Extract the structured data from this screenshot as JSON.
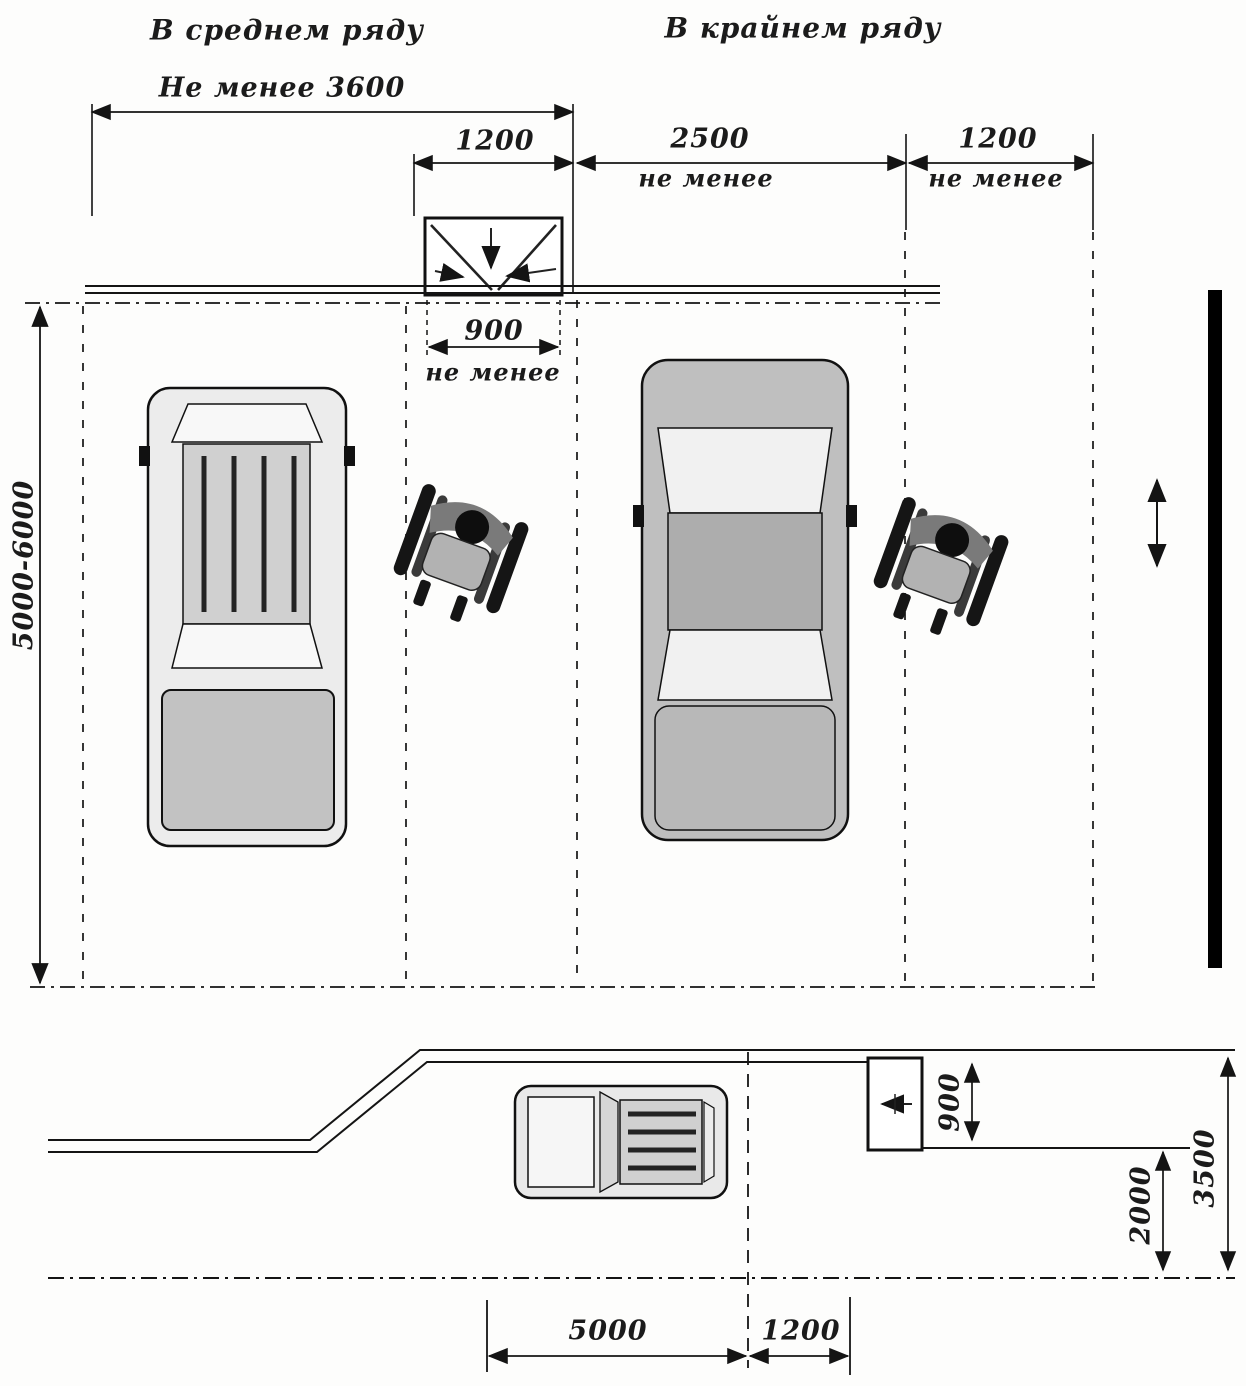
{
  "titles": {
    "middle_row": "В среднем ряду",
    "outer_row": "В крайнем ряду"
  },
  "labels": {
    "not_less": "не менее"
  },
  "dimensions": {
    "top_total": "Не менее 3600",
    "aisle_top": "1200",
    "stall_width": "2500",
    "aisle_right": "1200",
    "marking_width": "900",
    "stall_length": "5000-6000",
    "walkway_width": "900",
    "curb_offset": "2000",
    "lane_width": "3500",
    "parallel_stall_length": "5000",
    "parallel_gap": "1200"
  }
}
